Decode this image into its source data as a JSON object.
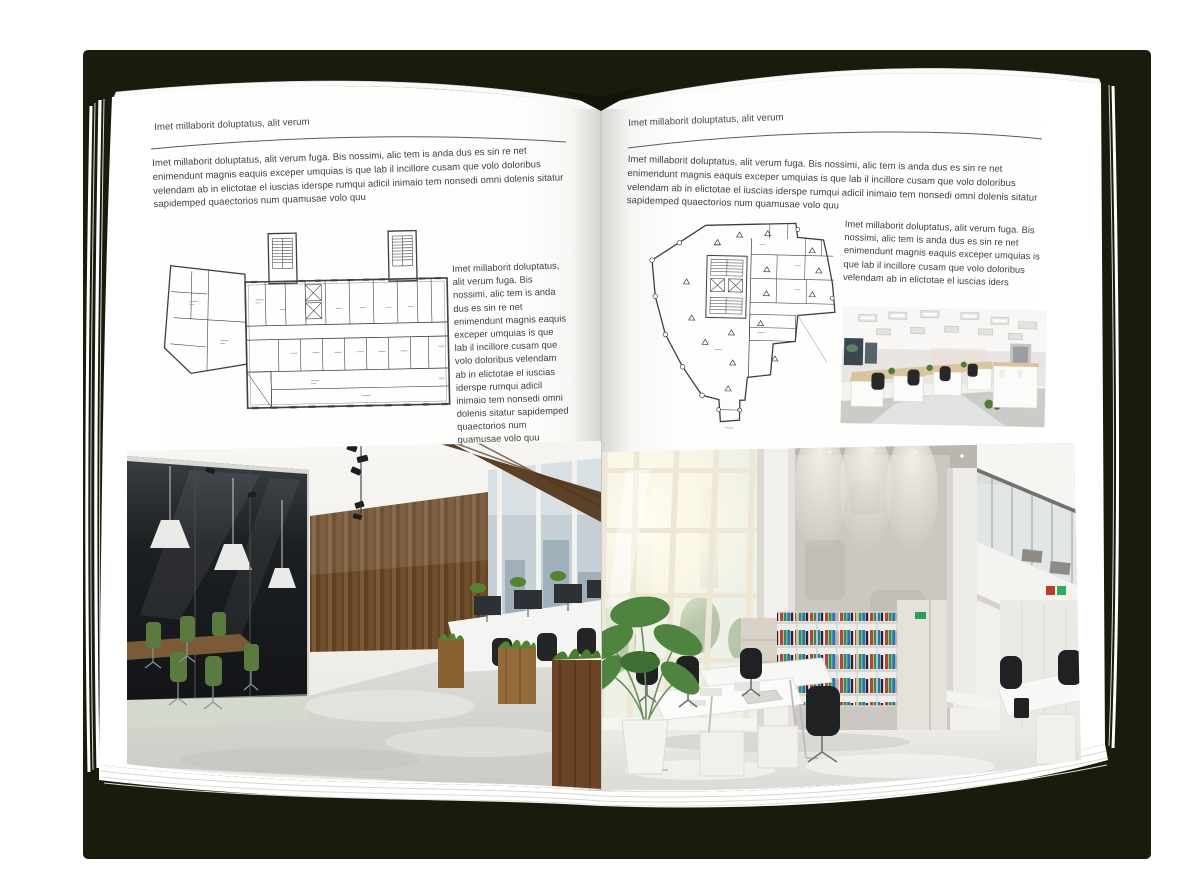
{
  "palette": {
    "backdrop_shadow": "#191b0c",
    "page": "#ffffff",
    "text": "#3e3e3e",
    "rule": "#5a5a5a",
    "plan_line": "#3f3f3f",
    "wood": "#6f4e2c",
    "chair_green": "#5a7a40",
    "plant_green": "#4f7d37"
  },
  "left_page": {
    "header": "Imet millaborit doluptatus, alit verum",
    "intro": "Imet millaborit doluptatus, alit verum fuga. Bis nossimi, alic tem is anda dus es sin re net enimendunt magnis eaquis exceper umquias is que lab il incillore cusam que volo doloribus velendam ab in elictotae el iuscias iderspe rumqui adicil inimaio tem nonsedi omni dolenis sitatur sapidemped quaectorios num quamusae volo quu",
    "caption": "Imet millaborit doluptatus, alit verum fuga. Bis nossimi, alic tem is anda dus es sin re net enimendunt magnis eaquis exceper umquias is que lab il incillore cusam que volo doloribus velendam ab in elictotae el iuscias iderspe rumqui adicil inimaio tem nonsedi omni dolenis sitatur sapidemped quaectorios num quamusae volo quu",
    "floor_plan_alt": "rectangular multi-room floor plan with two stair towers and angled left annex",
    "photo_alt": "loft office interior with wooden wall, glass meeting room, green chairs and planters"
  },
  "right_page": {
    "header": "Imet millaborit doluptatus, alit verum",
    "intro": "Imet millaborit doluptatus, alit verum fuga. Bis nossimi, alic tem is anda dus es sin re net enimendunt magnis eaquis exceper umquias is que lab il incillore cusam que volo doloribus velendam ab in elictotae el iuscias iderspe rumqui adicil inimaio tem nonsedi omni dolenis sitatur sapidemped quaectorios num quamusae volo quu",
    "caption": "Imet millaborit doluptatus, alit verum fuga. Bis nossimi, alic tem is anda dus es sin re net enimendunt magnis eaquis exceper umquias is que lab il incillore cusam que volo doloribus velendam ab in elictotae el iuscias iders",
    "floor_plan_alt": "irregular wedge-shaped floor plan with central stair core and perimeter columns",
    "photo_small_alt": "open-plan office with light cubicle workstations and black chairs",
    "photo_alt": "bright double-height office atrium with glazed wall, concrete panel, binder shelves and white desks"
  }
}
